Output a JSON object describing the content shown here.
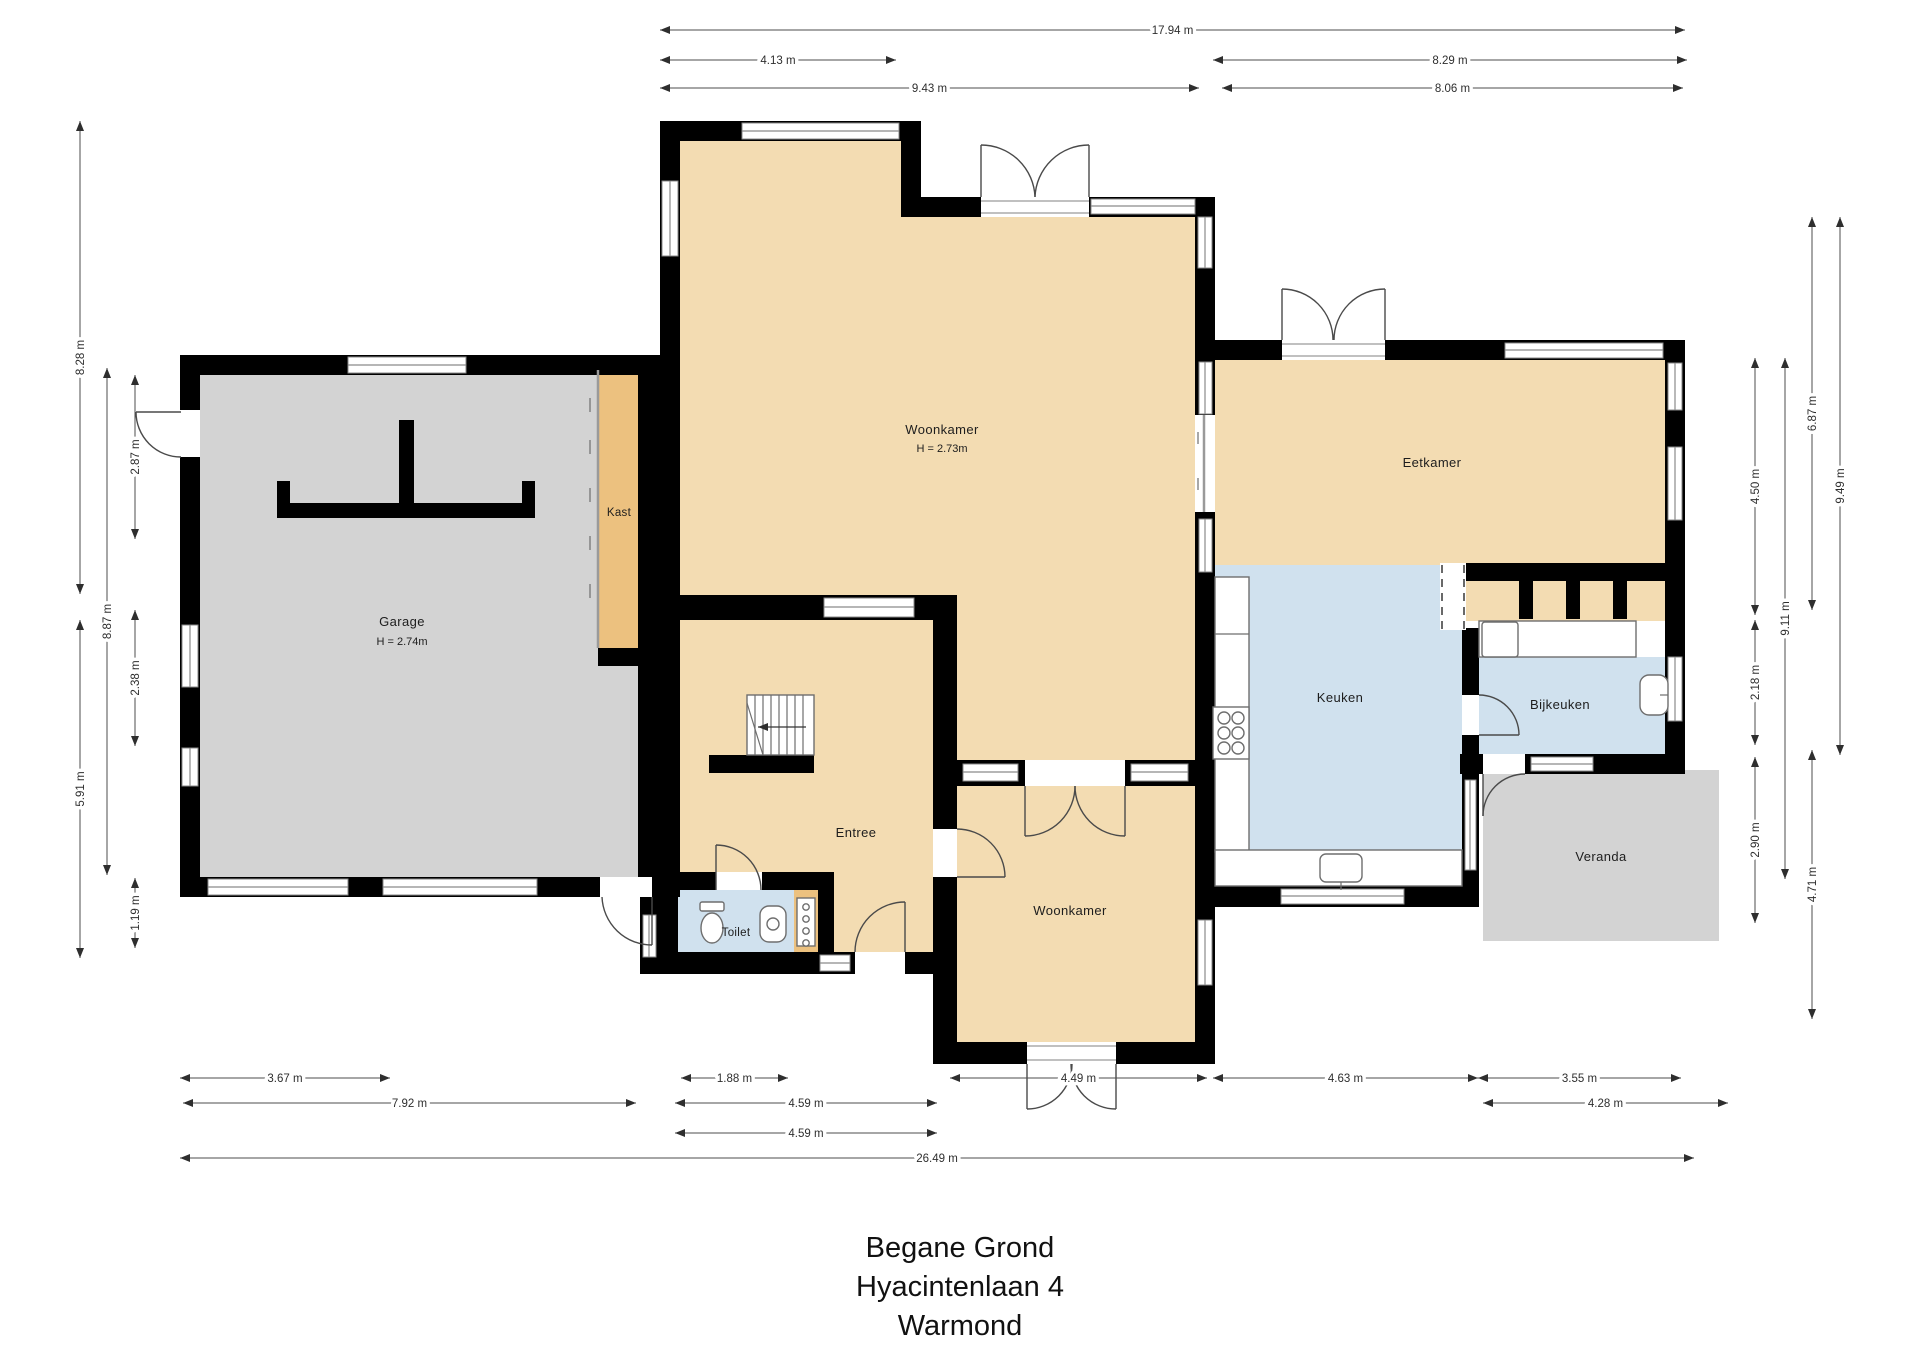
{
  "title": {
    "lines": [
      "Begane Grond",
      "Hyacintenlaan 4",
      "Warmond"
    ]
  },
  "rooms": {
    "garage": {
      "name": "Garage",
      "height": "H = 2.74m"
    },
    "kast": {
      "name": "Kast"
    },
    "woonkamer_top": {
      "name": "Woonkamer",
      "height": "H = 2.73m"
    },
    "eetkamer": {
      "name": "Eetkamer"
    },
    "keuken": {
      "name": "Keuken"
    },
    "bijkeuken": {
      "name": "Bijkeuken"
    },
    "veranda": {
      "name": "Veranda"
    },
    "entree": {
      "name": "Entree"
    },
    "toilet": {
      "name": "Toilet"
    },
    "woonkamer_bottom": {
      "name": "Woonkamer"
    }
  },
  "colors": {
    "floor_tan": "#f3dcb2",
    "cabinet_orange": "#ecc17f",
    "floor_blue": "#d0e1ee",
    "floor_gray": "#d3d3d3",
    "wall_black": "#000000",
    "dimension_line": "#4d4d4d",
    "text": "#1d1d1d"
  },
  "dimensions": [
    {
      "label": "17.94 m",
      "dir": "h",
      "x1": 660,
      "x2": 1685,
      "y": 30
    },
    {
      "label": "4.13 m",
      "dir": "h",
      "x1": 660,
      "x2": 896,
      "y": 60
    },
    {
      "label": "8.29 m",
      "dir": "h",
      "x1": 1213,
      "x2": 1687,
      "y": 60
    },
    {
      "label": "9.43 m",
      "dir": "h",
      "x1": 660,
      "x2": 1199,
      "y": 88
    },
    {
      "label": "8.06 m",
      "dir": "h",
      "x1": 1222,
      "x2": 1683,
      "y": 88
    },
    {
      "label": "3.67 m",
      "dir": "h",
      "x1": 180,
      "x2": 390,
      "y": 1078
    },
    {
      "label": "1.88 m",
      "dir": "h",
      "x1": 681,
      "x2": 788,
      "y": 1078
    },
    {
      "label": "4.49 m",
      "dir": "h",
      "x1": 950,
      "x2": 1207,
      "y": 1078
    },
    {
      "label": "4.63 m",
      "dir": "h",
      "x1": 1213,
      "x2": 1478,
      "y": 1078
    },
    {
      "label": "3.55 m",
      "dir": "h",
      "x1": 1478,
      "x2": 1681,
      "y": 1078
    },
    {
      "label": "7.92 m",
      "dir": "h",
      "x1": 183,
      "x2": 636,
      "y": 1103
    },
    {
      "label": "4.59 m",
      "dir": "h",
      "x1": 675,
      "x2": 937,
      "y": 1103
    },
    {
      "label": "4.28 m",
      "dir": "h",
      "x1": 1483,
      "x2": 1728,
      "y": 1103
    },
    {
      "label": "4.59 m",
      "dir": "h",
      "x1": 675,
      "x2": 937,
      "y": 1133
    },
    {
      "label": "26.49 m",
      "dir": "h",
      "x1": 180,
      "x2": 1694,
      "y": 1158
    },
    {
      "label": "8.28 m",
      "dir": "v",
      "x": 80,
      "y1": 121,
      "y2": 594
    },
    {
      "label": "5.91 m",
      "dir": "v",
      "x": 80,
      "y1": 620,
      "y2": 958
    },
    {
      "label": "8.87 m",
      "dir": "v",
      "x": 107,
      "y1": 368,
      "y2": 875
    },
    {
      "label": "2.87 m",
      "dir": "v",
      "x": 135,
      "y1": 375,
      "y2": 539
    },
    {
      "label": "2.38 m",
      "dir": "v",
      "x": 135,
      "y1": 610,
      "y2": 746
    },
    {
      "label": "1.19 m",
      "dir": "v",
      "x": 135,
      "y1": 878,
      "y2": 948
    },
    {
      "label": "6.87 m",
      "dir": "v",
      "x": 1812,
      "y1": 217,
      "y2": 610
    },
    {
      "label": "9.49 m",
      "dir": "v",
      "x": 1840,
      "y1": 217,
      "y2": 755
    },
    {
      "label": "4.50 m",
      "dir": "v",
      "x": 1755,
      "y1": 358,
      "y2": 615
    },
    {
      "label": "9.11 m",
      "dir": "v",
      "x": 1785,
      "y1": 358,
      "y2": 879
    },
    {
      "label": "2.18 m",
      "dir": "v",
      "x": 1755,
      "y1": 620,
      "y2": 745
    },
    {
      "label": "2.90 m",
      "dir": "v",
      "x": 1755,
      "y1": 757,
      "y2": 923
    },
    {
      "label": "4.71 m",
      "dir": "v",
      "x": 1812,
      "y1": 750,
      "y2": 1019
    }
  ]
}
